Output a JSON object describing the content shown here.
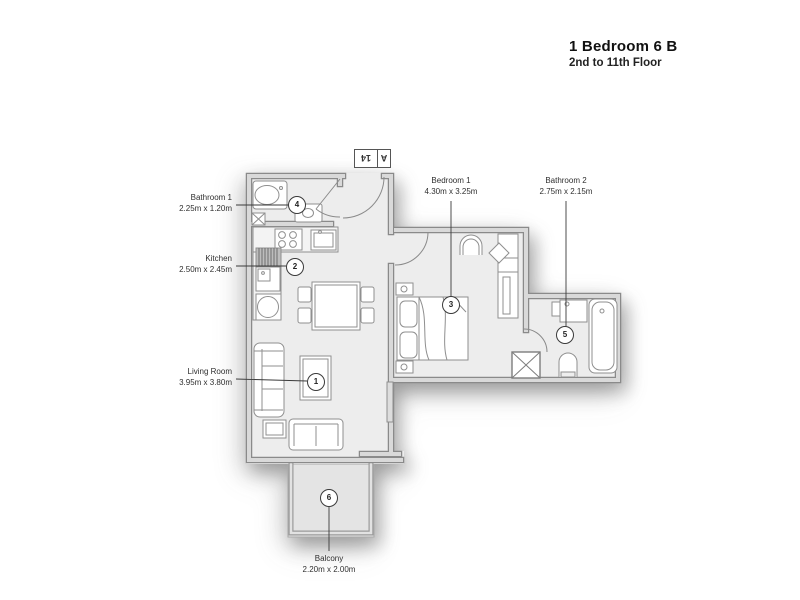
{
  "header": {
    "title": "1 Bedroom 6 B",
    "subtitle": "2nd to 11th Floor"
  },
  "unit_tag": {
    "building": "A",
    "number": "14"
  },
  "rooms": [
    {
      "name": "Living Room",
      "dims": "3.95m x 3.80m",
      "marker": "1"
    },
    {
      "name": "Kitchen",
      "dims": "2.50m x 2.45m",
      "marker": "2"
    },
    {
      "name": "Bedroom 1",
      "dims": "4.30m x 3.25m",
      "marker": "3"
    },
    {
      "name": "Bathroom 1",
      "dims": "2.25m x 1.20m",
      "marker": "4"
    },
    {
      "name": "Bathroom 2",
      "dims": "2.75m x 2.15m",
      "marker": "5"
    },
    {
      "name": "Balcony",
      "dims": "2.20m x 2.00m",
      "marker": "6"
    }
  ],
  "colors": {
    "wall_edge": "#8a8a8a",
    "wall_fill": "#d9d9d9",
    "floor": "#ededed",
    "balcony_floor": "#e4e4e4",
    "furniture_stroke": "#8f8f8f",
    "text": "#2f2f2f"
  }
}
